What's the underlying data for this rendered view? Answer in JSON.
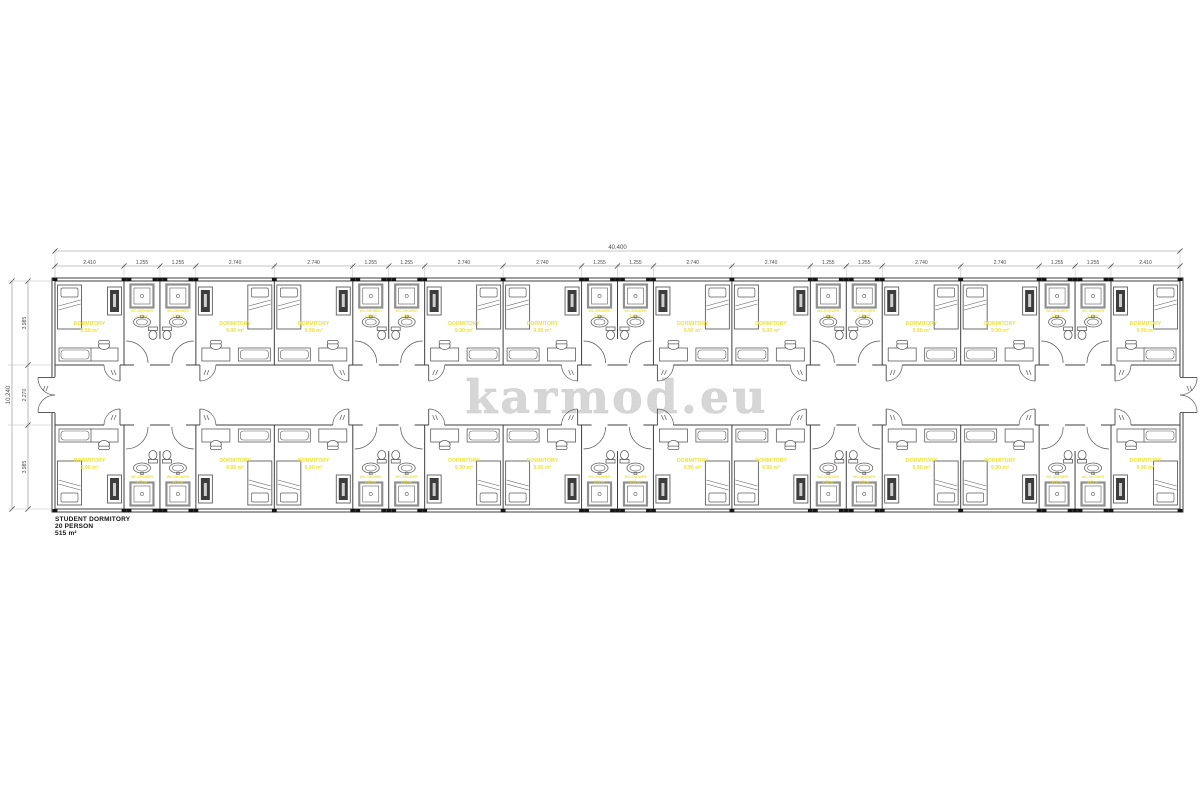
{
  "watermark": "karmod.eu",
  "title_block": {
    "line1": "STUDENT DORMITORY",
    "line2": "20 PERSON",
    "line3": "515 m²"
  },
  "room": {
    "label": "DORMITORY",
    "area": "9.90 m²"
  },
  "bathroom": {
    "label": "WC-SHOWER",
    "area": "1.75 m²"
  },
  "dimensions": {
    "top_total": "40.400",
    "top_segments": [
      "2.410",
      "1.255",
      "1.255",
      "2.740",
      "2.740",
      "1.255",
      "1.255",
      "2.740",
      "2.740",
      "1.255",
      "1.255",
      "2.740",
      "2.740",
      "1.255",
      "1.255",
      "2.740",
      "2.740",
      "1.255",
      "1.255",
      "2.410"
    ],
    "left_total": "10.240",
    "left_segments": [
      "3.985",
      "2.270",
      "3.985"
    ]
  },
  "colors": {
    "label_yellow": "#ebe43a",
    "wall": "#3f3f3f",
    "furniture": "#5c5c5c",
    "dimension": "#8a8a8a",
    "watermark_gray": "#d6d6d6",
    "joint_black": "#141414"
  }
}
